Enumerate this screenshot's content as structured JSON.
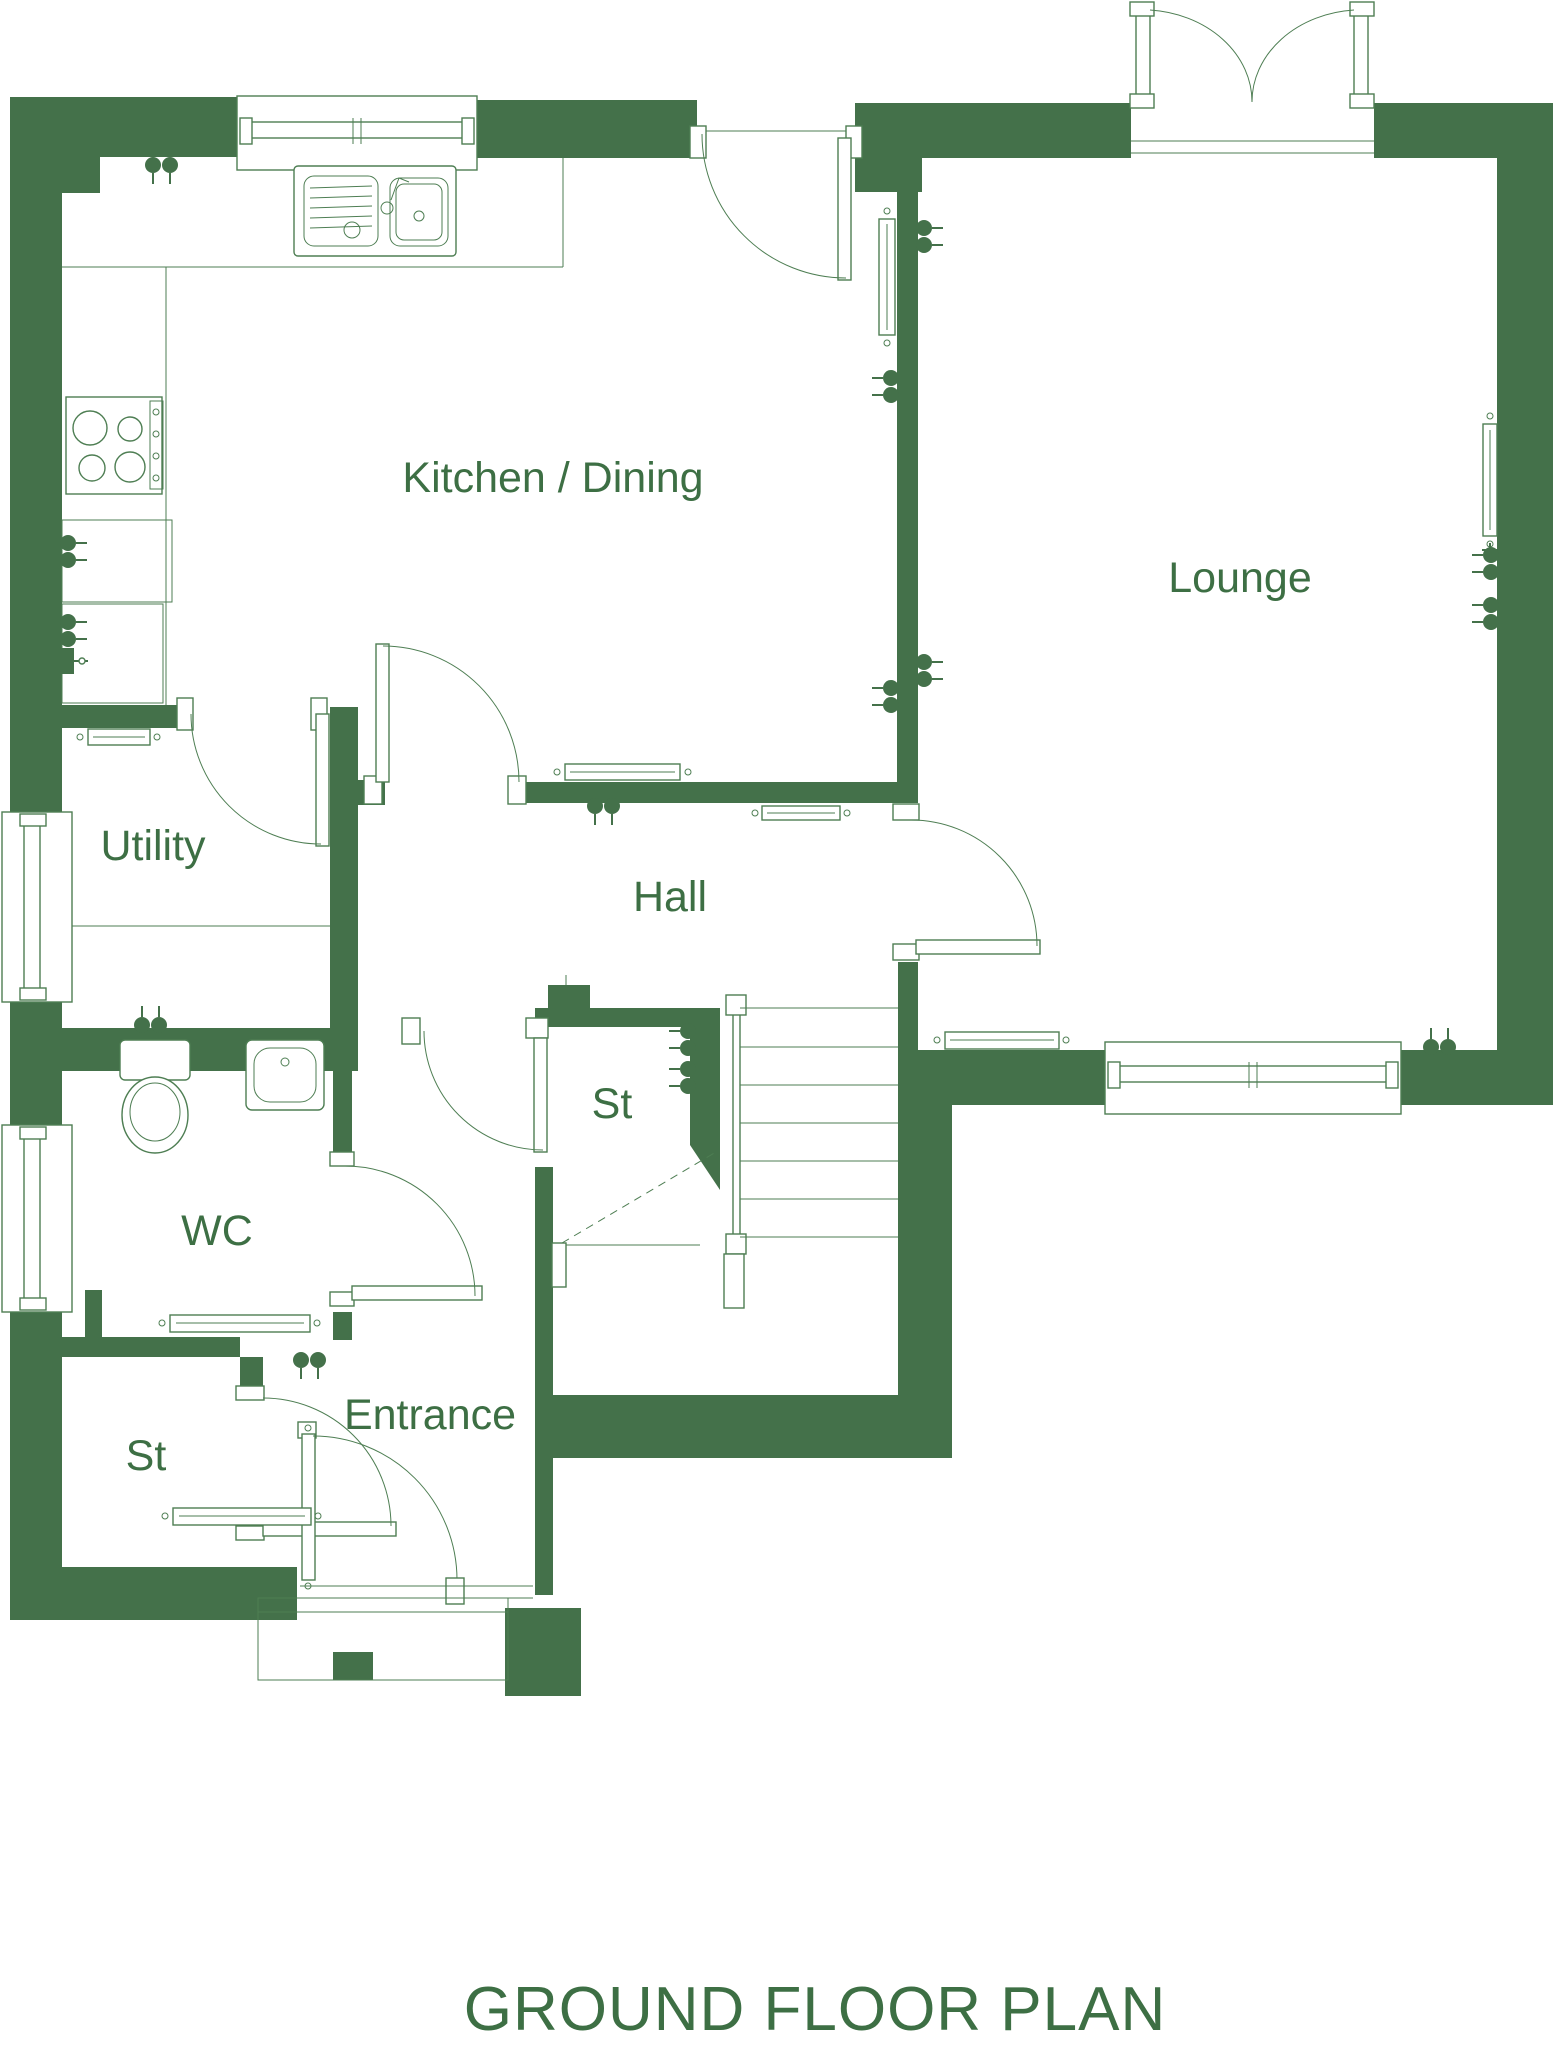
{
  "title": "GROUND FLOOR PLAN",
  "colors": {
    "wall_green": "#44714a",
    "line_green": "#4e7e53",
    "text_green": "#3d6f44",
    "background": "#ffffff"
  },
  "rooms": [
    {
      "name": "kitchen-dining",
      "label": "Kitchen / Dining"
    },
    {
      "name": "lounge",
      "label": "Lounge"
    },
    {
      "name": "utility",
      "label": "Utility"
    },
    {
      "name": "hall",
      "label": "Hall"
    },
    {
      "name": "store-under-stairs",
      "label": "St"
    },
    {
      "name": "wc",
      "label": "WC"
    },
    {
      "name": "store-entrance",
      "label": "St"
    },
    {
      "name": "entrance",
      "label": "Entrance"
    }
  ],
  "fixtures": [
    "kitchen-sink",
    "hob",
    "kitchen-worktop",
    "toilet",
    "wash-basin",
    "staircase",
    "radiator",
    "double-socket",
    "window",
    "door",
    "french-doors",
    "porch-canopy"
  ]
}
